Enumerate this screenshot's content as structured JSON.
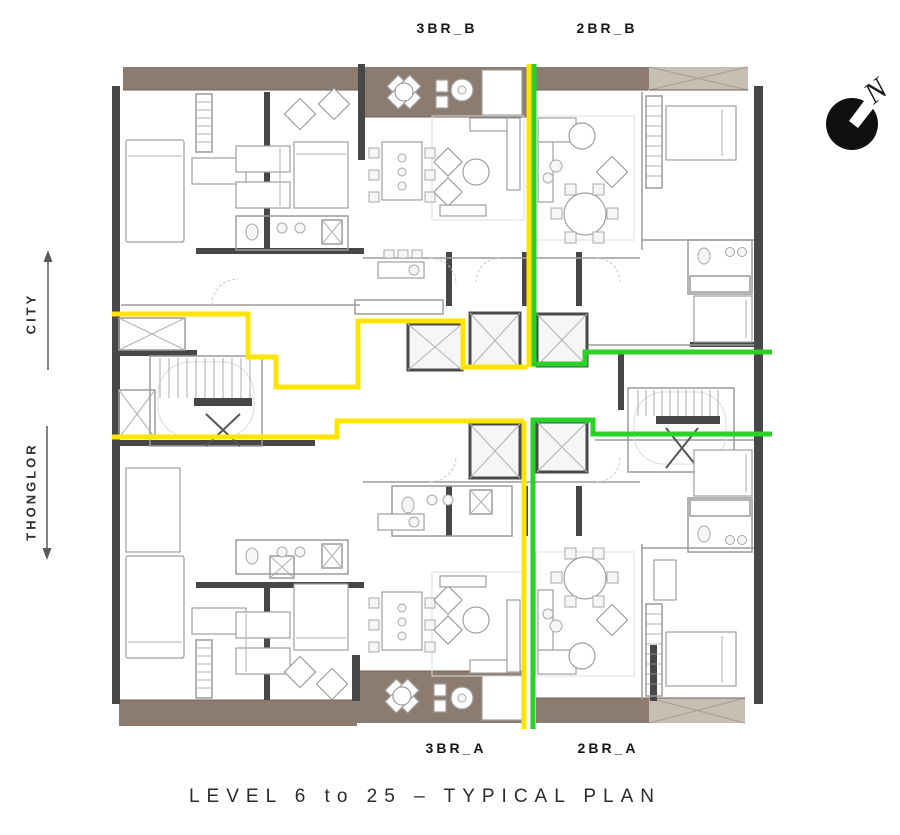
{
  "plan": {
    "units": {
      "top_left": "3BR_B",
      "top_right": "2BR_B",
      "bottom_left": "3BR_A",
      "bottom_right": "2BR_A"
    },
    "directions": {
      "up": "CITY",
      "down": "THONGLOR"
    },
    "compass_north": "N",
    "title": "LEVEL 6 to 25 – TYPICAL PLAN"
  },
  "colors": {
    "divider-yellow": "#FFE400",
    "divider-green": "#28D228",
    "balcony-brown": "#8C7C6F",
    "ledge-tan": "#C8BFB4",
    "wall-dark": "#474747",
    "text-dark": "#222222"
  }
}
